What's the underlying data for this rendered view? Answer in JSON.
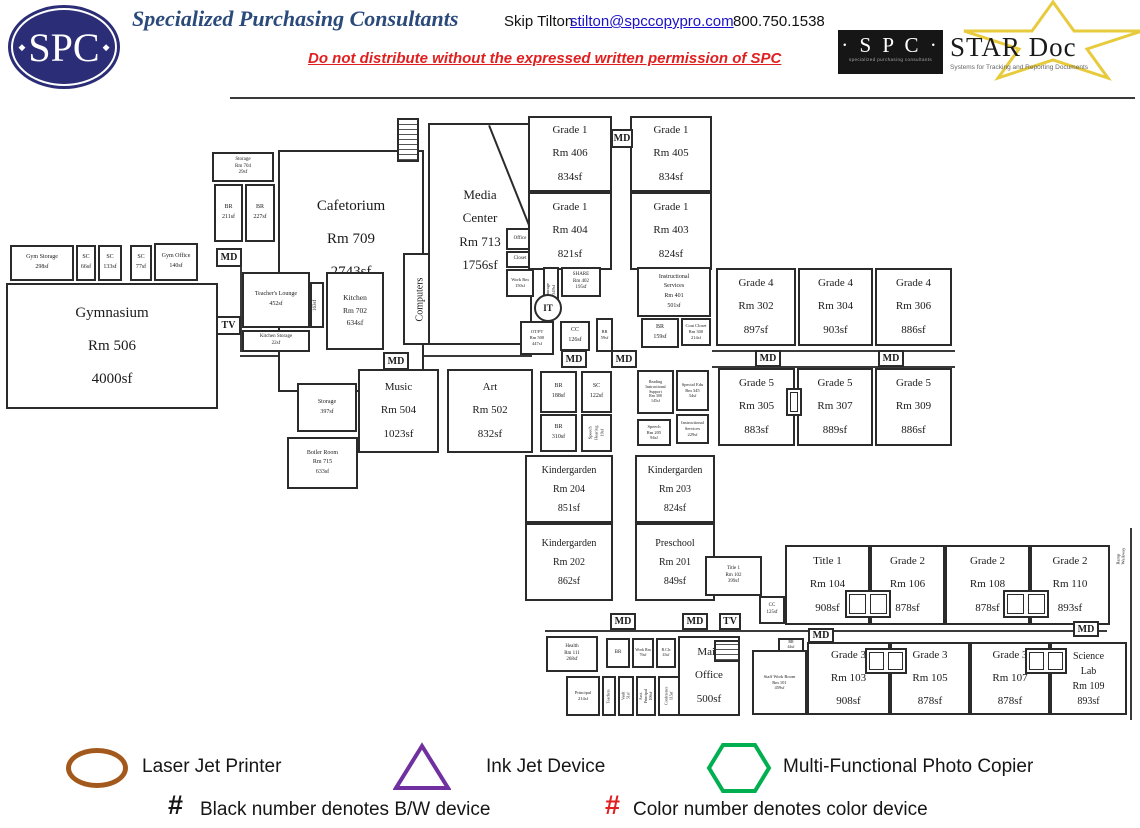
{
  "header": {
    "logo_text": "SPC",
    "company": "Specialized Purchasing Consultants",
    "contact_name": "Skip Tilton",
    "contact_email": "stilton@spccopypro.com",
    "contact_phone": "800.750.1538",
    "notice": "Do not distribute without the expressed written permission of SPC",
    "stardoc": {
      "spc": "· S P C ·",
      "spc_tagline": "specialized purchasing consultants",
      "name": "STAR Doc",
      "tagline": "Systems for Tracking and Reporting Documents"
    }
  },
  "markers": {
    "md": "MD",
    "tv": "TV",
    "it": "IT"
  },
  "rooms": {
    "gym_storage": "Gym Storage\n298sf",
    "sc_66": "SC\n66sf",
    "sc_133": "SC\n133sf",
    "sc_77": "SC\n77sf",
    "gym_office": "Gym Office\n140sf",
    "gymnasium": "Gymnasium\nRm 506\n4000sf",
    "storage_704": "Storage\nRm 704\n29sf",
    "br_211": "BR\n211sf",
    "br_227": "BR\n227sf",
    "cafetorium": "Cafetorium\nRm 709\n2743sf",
    "teachers_lounge": "Teacher's Lounge\n452sf",
    "kitchen": "Kitchen\nRm 702\n634sf",
    "k_163": "163sf",
    "kitchen_storage": "Kitchen Storage\n22sf",
    "computers": "Computers",
    "rm_507": "Rm 507\n75sf",
    "media_center": "Media\nCenter\nRm 713\n1756sf",
    "office": "Office",
    "closet": "Closet",
    "work_rm": "Work Rm\n150sf",
    "grade1_406": "Grade 1\nRm 406\n834sf",
    "grade1_404": "Grade 1\nRm 404\n821sf",
    "grade1_405": "Grade 1\nRm 405\n834sf",
    "grade1_403": "Grade 1\nRm 403\n824sf",
    "share": "SHARE\nRm 402\n195sf",
    "storage_349": "Storage\n349sf",
    "otpt": "OT/PT\nRm 500\n447sf",
    "cc_126": "CC\n126sf",
    "br_59": "BR\n59sf",
    "instructional_services": "Instructional\nServices\nRm 401\n501sf",
    "br_159": "BR\n159sf",
    "coat_closet": "Coat Closet\nRm 300\n214sf",
    "grade4_302": "Grade 4\nRm 302\n897sf",
    "grade4_304": "Grade 4\nRm 304\n903sf",
    "grade4_306": "Grade 4\nRm 306\n886sf",
    "grade5_305": "Grade 5\nRm 305\n883sf",
    "grade5_307": "Grade 5\nRm 307\n889sf",
    "grade5_309": "Grade 5\nRm 309\n886sf",
    "storage_397": "Storage\n397sf",
    "boiler": "Boiler Room\nRm 715\n633sf",
    "sc_cl_1": "SC\nCl.",
    "sc_cl_2": "SC\nCl.",
    "storage_7": "Storage\n7sf",
    "music": "Music\nRm 504\n1023sf",
    "art": "Art\nRm 502\n832sf",
    "br_188": "BR\n188sf",
    "sc_122": "SC\n122sf",
    "br_310": "BR\n310sf",
    "speech_hearing": "Speech\nHearing\n19sf",
    "reading_support": "Reading\nInstructional\nSupport\nRm 308\n145sf",
    "special_edu": "Special Edu\nRm 345\n34sf",
    "speech_205": "Speech\nRm 205\n94sf",
    "instructional_services_2": "Instructional\nServices\n229sf",
    "kindergarden_204": "Kindergarden\nRm 204\n851sf",
    "kindergarden_202": "Kindergarden\nRm 202\n862sf",
    "kindergarden_203": "Kindergarden\nRm 203\n824sf",
    "preschool_201": "Preschool\nRm 201\n849sf",
    "title1_102": "Title 1\nRm 102\n399sf",
    "cc_125": "CC\n125sf",
    "title1_104": "Title 1\nRm 104\n908sf",
    "grade2_106": "Grade 2\nRm 106\n878sf",
    "grade2_108": "Grade 2\nRm 108\n878sf",
    "grade2_110": "Grade 2\nRm 110\n893sf",
    "walkway": "Ramp Walkway",
    "health": "Health\nRm 111\n268sf",
    "principal": "Principal\n214sf",
    "teachers_room": "Teachers",
    "vault": "Vault\n51sf",
    "asst_principal": "Asst. Principal\n106sf",
    "conference": "Conference\n115sf",
    "br_office": "BR",
    "work_76": "Work Rm\n76sf",
    "b_cls": "B.Cls\n43sf",
    "main_office": "Main\nOffice\n500sf",
    "staff_work": "Staff Work Room\nRm 101\n459sf",
    "br_44": "BR\n44sf",
    "grade3_103": "Grade 3\nRm 103\n908sf",
    "grade3_105": "Grade 3\nRm 105\n878sf",
    "grade3_107": "Grade 3\nRm 107\n878sf",
    "science_lab": "Science\nLab\nRm 109\n893sf"
  },
  "legend": {
    "laser": "Laser Jet Printer",
    "inkjet": "Ink Jet Device",
    "copier": "Multi-Functional Photo Copier",
    "hash": "#",
    "bw_note": "Black number denotes B/W device",
    "color_note": "Color number denotes color device",
    "colors": {
      "laser": "#a3591c",
      "inkjet": "#7030a0",
      "copier": "#00b050",
      "hash_red": "#e02020"
    }
  }
}
